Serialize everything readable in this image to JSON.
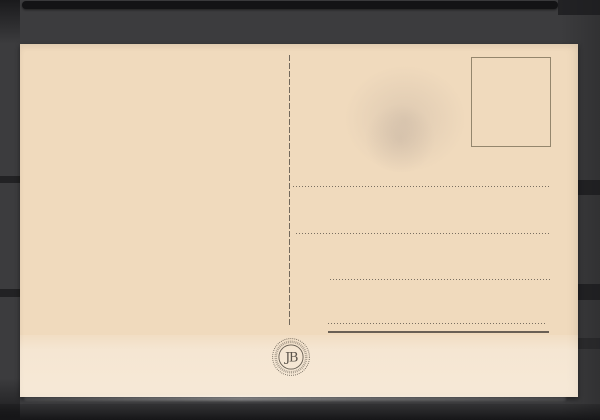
{
  "colors": {
    "bg": "#3c3c3e",
    "bg-dark": "#1a1a1c",
    "slot": "#131315",
    "card": "#f0dabd",
    "ink": "#5c544a",
    "ink-dark": "#474039",
    "stamp-border": "#84775f"
  },
  "postcard": {
    "emblem": {
      "monogram": "JB"
    },
    "address_lines": {
      "dotted_count": 4,
      "solid_count": 1
    }
  }
}
